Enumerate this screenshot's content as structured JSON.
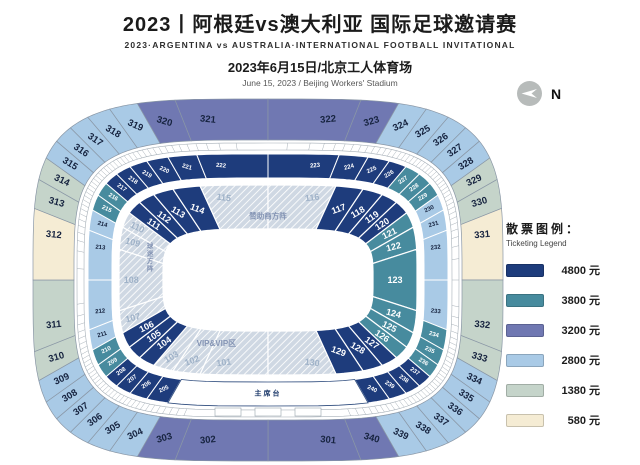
{
  "header": {
    "title_cn": "2023丨阿根廷vs澳大利亚 国际足球邀请赛",
    "title_en": "2023·ARGENTINA vs AUSTRALIA·INTERNATIONAL FOOTBALL INVITATIONAL",
    "date_cn": "2023年6月15日/北京工人体育场",
    "date_en": "June 15, 2023 / Beijing Workers' Stadium"
  },
  "compass": {
    "label": "N"
  },
  "colors": {
    "t4800": "#1e3c7c",
    "t3800": "#478b9e",
    "t3200": "#7078b2",
    "t2800": "#a9cae6",
    "t1380": "#c5d4ca",
    "t580": "#f5ecd4"
  },
  "legend": {
    "title_cn": "散票图例：",
    "title_en": "Ticketing Legend",
    "items": [
      {
        "price": "4800 元",
        "tier": "t4800"
      },
      {
        "price": "3800 元",
        "tier": "t3800"
      },
      {
        "price": "3200 元",
        "tier": "t3200"
      },
      {
        "price": "2800 元",
        "tier": "t2800"
      },
      {
        "price": "1380 元",
        "tier": "t1380"
      },
      {
        "price": "580 元",
        "tier": "t580"
      }
    ]
  },
  "stadium": {
    "stage_label": "主席台",
    "areas": {
      "sponsor_block": "赞助商方阵",
      "vip_block": "VIP&VIP区",
      "west_block": "球迷方阵"
    },
    "rings": {
      "outer": [
        [
          "301",
          "t3200"
        ],
        [
          "302",
          "t3200"
        ],
        [
          "303",
          "t3200"
        ],
        [
          "304",
          "t2800"
        ],
        [
          "305",
          "t2800"
        ],
        [
          "306",
          "t2800"
        ],
        [
          "307",
          "t2800"
        ],
        [
          "308",
          "t2800"
        ],
        [
          "309",
          "t2800"
        ],
        [
          "310",
          "t1380"
        ],
        [
          "311",
          "t1380"
        ],
        [
          "312",
          "t580"
        ],
        [
          "313",
          "t1380"
        ],
        [
          "314",
          "t1380"
        ],
        [
          "315",
          "t2800"
        ],
        [
          "316",
          "t2800"
        ],
        [
          "317",
          "t2800"
        ],
        [
          "318",
          "t2800"
        ],
        [
          "319",
          "t2800"
        ],
        [
          "320",
          "t3200"
        ],
        [
          "321",
          "t3200"
        ],
        [
          "322",
          "t3200"
        ],
        [
          "323",
          "t3200"
        ],
        [
          "324",
          "t2800"
        ],
        [
          "325",
          "t2800"
        ],
        [
          "326",
          "t2800"
        ],
        [
          "327",
          "t2800"
        ],
        [
          "328",
          "t2800"
        ],
        [
          "329",
          "t1380"
        ],
        [
          "330",
          "t1380"
        ],
        [
          "331",
          "t580"
        ],
        [
          "332",
          "t1380"
        ],
        [
          "333",
          "t1380"
        ],
        [
          "334",
          "t2800"
        ],
        [
          "335",
          "t2800"
        ],
        [
          "336",
          "t2800"
        ],
        [
          "337",
          "t2800"
        ],
        [
          "338",
          "t2800"
        ],
        [
          "339",
          "t2800"
        ],
        [
          "340",
          "t3200"
        ]
      ],
      "middle": [
        [
          "205",
          "t4800"
        ],
        [
          "206",
          "t4800"
        ],
        [
          "207",
          "t4800"
        ],
        [
          "208",
          "t4800"
        ],
        [
          "209",
          "t3800"
        ],
        [
          "210",
          "t3800"
        ],
        [
          "211",
          "t2800"
        ],
        [
          "212",
          "t2800"
        ],
        [
          "213",
          "t2800"
        ],
        [
          "214",
          "t2800"
        ],
        [
          "215",
          "t3800"
        ],
        [
          "216",
          "t3800"
        ],
        [
          "217",
          "t4800"
        ],
        [
          "218",
          "t4800"
        ],
        [
          "219",
          "t4800"
        ],
        [
          "220",
          "t4800"
        ],
        [
          "221",
          "t4800"
        ],
        [
          "222",
          "t4800"
        ],
        [
          "223",
          "t4800"
        ],
        [
          "224",
          "t4800"
        ],
        [
          "225",
          "t4800"
        ],
        [
          "226",
          "t4800"
        ],
        [
          "227",
          "t3800"
        ],
        [
          "228",
          "t3800"
        ],
        [
          "229",
          "t3800"
        ],
        [
          "230",
          "t2800"
        ],
        [
          "231",
          "t2800"
        ],
        [
          "232",
          "t2800"
        ],
        [
          "233",
          "t2800"
        ],
        [
          "234",
          "t3800"
        ],
        [
          "235",
          "t3800"
        ],
        [
          "236",
          "t3800"
        ],
        [
          "237",
          "t4800"
        ],
        [
          "238",
          "t4800"
        ],
        [
          "239",
          "t4800"
        ],
        [
          "240",
          "t4800"
        ]
      ],
      "inner": [
        [
          "101",
          "hatch"
        ],
        [
          "102",
          "hatch"
        ],
        [
          "103",
          "hatch"
        ],
        [
          "104",
          "t4800"
        ],
        [
          "105",
          "t4800"
        ],
        [
          "106",
          "t4800"
        ],
        [
          "107",
          "hatch"
        ],
        [
          "108",
          "hatch"
        ],
        [
          "109",
          "hatch"
        ],
        [
          "110",
          "hatch"
        ],
        [
          "111",
          "t4800"
        ],
        [
          "112",
          "t4800"
        ],
        [
          "113",
          "t4800"
        ],
        [
          "114",
          "t4800"
        ],
        [
          "115",
          "hatch"
        ],
        [
          "116",
          "hatch"
        ],
        [
          "117",
          "t4800"
        ],
        [
          "118",
          "t4800"
        ],
        [
          "119",
          "t4800"
        ],
        [
          "120",
          "t4800"
        ],
        [
          "121",
          "t3800"
        ],
        [
          "122",
          "t3800"
        ],
        [
          "123",
          "t3800"
        ],
        [
          "124",
          "t3800"
        ],
        [
          "125",
          "t3800"
        ],
        [
          "126",
          "t3800"
        ],
        [
          "127",
          "t4800"
        ],
        [
          "128",
          "t4800"
        ],
        [
          "129",
          "t4800"
        ],
        [
          "130",
          "hatch"
        ]
      ]
    }
  }
}
